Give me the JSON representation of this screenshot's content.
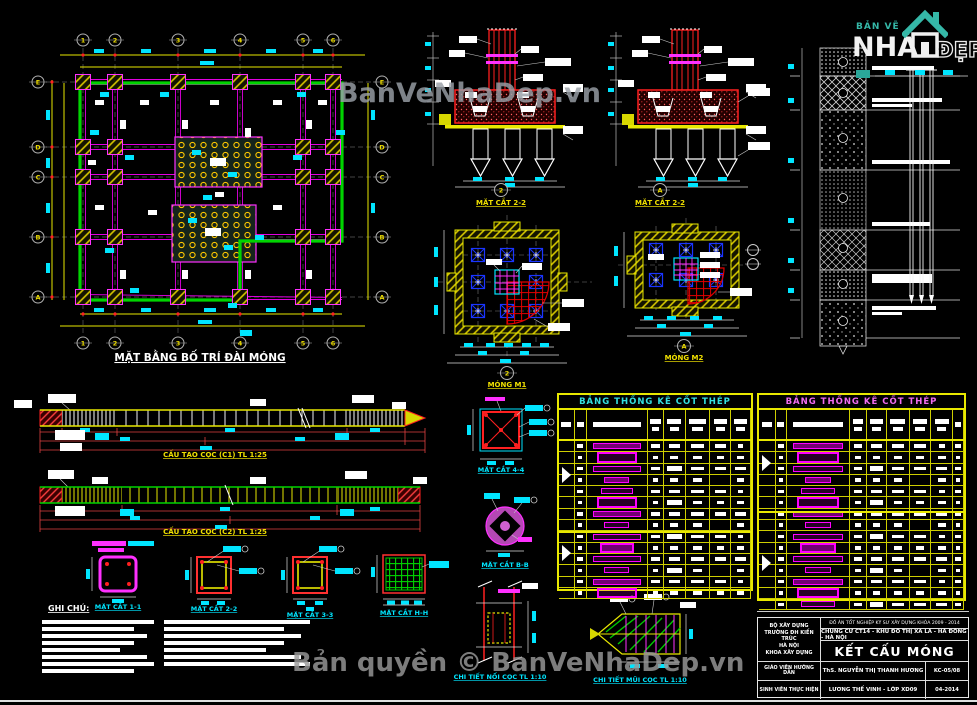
{
  "watermarks": {
    "center": "BanVeNhaDep.vn",
    "bottom": "Bản quyền © BanVeNhaDep.vn"
  },
  "logo": {
    "top": "BẢN VẼ",
    "main": "NHÀ",
    "right": "ĐẸP"
  },
  "plan": {
    "title": "MẶT BẰNG BỐ TRÍ ĐÀI MÓNG",
    "cols": [
      "1",
      "2",
      "3",
      "4",
      "5",
      "6"
    ],
    "rows": [
      "E",
      "D",
      "C",
      "B",
      "A"
    ]
  },
  "sections": [
    {
      "bubble": "2",
      "title": "MẶT CẮT 2-2"
    },
    {
      "bubble": "A",
      "title": "MẶT CẮT 2-2"
    }
  ],
  "foundations": [
    {
      "bubble": "2",
      "title": "MÓNG M1"
    },
    {
      "bubble": "A",
      "title": "MÓNG M2"
    }
  ],
  "pile_details": [
    {
      "title": "CẤU TẠO CỌC (C1) TL 1:25"
    },
    {
      "title": "CẤU TẠO CỌC (C2) TL 1:25"
    }
  ],
  "cross_sections": [
    {
      "title": "MẶT CẮT 1-1"
    },
    {
      "title": "MẶT CẮT 2-2"
    },
    {
      "title": "MẶT CẮT 3-3"
    },
    {
      "title": "MẶT CẮT H-H"
    }
  ],
  "detail_sections": [
    {
      "title": "MẶT CẮT 4-4"
    },
    {
      "title": "MẶT CẮT B-B"
    }
  ],
  "bottom_details": [
    {
      "title": "CHI TIẾT NỐI CỌC TL 1:10"
    },
    {
      "title": "CHI TIẾT MŨI CỌC TL 1:10"
    }
  ],
  "rebar_tables": [
    {
      "title": "BẢNG THỐNG KÊ CỐT THÉP"
    },
    {
      "title": "BẢNG THỐNG KÊ CỐT THÉP"
    }
  ],
  "notes": {
    "heading": "GHI CHÚ:"
  },
  "title_block": {
    "org_lines": [
      "BỘ XÂY DỰNG",
      "TRƯỜNG ĐH KIẾN TRÚC",
      "HÀ NỘI",
      "KHOA XÂY DỰNG"
    ],
    "project_line": "ĐỒ ÁN TỐT NGHIỆP KỸ SƯ XÂY DỰNG KHÓA 2009 - 2014",
    "building_line": "CHUNG CƯ CT14 - KHU ĐÔ THỊ XA LA - HÀ ĐÔNG - HÀ NỘI",
    "drawing_title": "KẾT CẤU MÓNG",
    "rows": [
      {
        "label": "GIÁO VIÊN HƯỚNG DẪN",
        "value": "ThS. NGUYỄN THỊ THANH HƯƠNG",
        "code": "KC-05/08"
      },
      {
        "label": "SINH VIÊN THỰC HIỆN",
        "value": "LƯƠNG THẾ VINH - LỚP XD09",
        "code": "04-2014"
      }
    ]
  },
  "colors": {
    "yellow": "#ffff00",
    "cyan": "#00ffff",
    "magenta": "#ff00ff",
    "green": "#00ff00",
    "red": "#ff2020",
    "pile_blue": "#1a35ff",
    "logo_teal": "#35b8a8",
    "watermark_gray": "#9a9a9a"
  }
}
